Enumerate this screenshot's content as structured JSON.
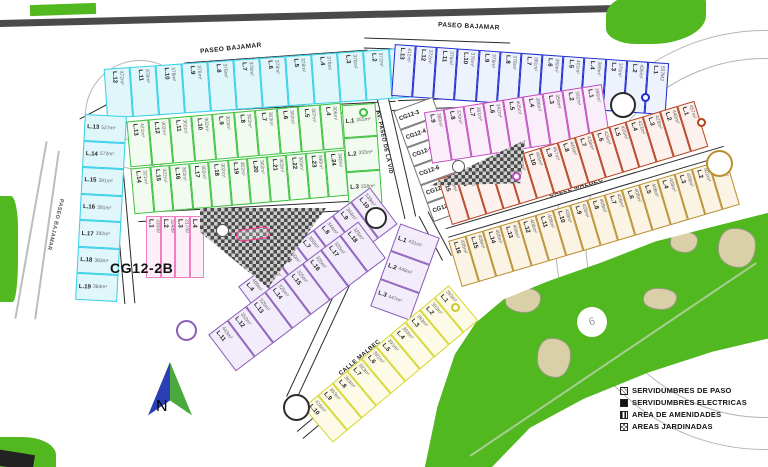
{
  "site_code": "CG12-2B",
  "north": {
    "label": "N"
  },
  "golf": {
    "hole_label": "6"
  },
  "streets": {
    "paseo_bajamar": "PASEO BAJAMAR",
    "calle_nebbiolo": "CALLE NEBBIOLO",
    "calle_pinot_noir": "CALLE PINOT NOIR",
    "av_paseo_de_la_vid": "AV. PASEO DE LA VID",
    "calle_syrah": "CALLE SYRAH",
    "calle_malbec": "CALLE MALBEC"
  },
  "legend": {
    "items": [
      {
        "label": "SERVIDUMBRES DE PASO",
        "swatch": "hatch-diagonal"
      },
      {
        "label": "SERVIDUMBRES ELECTRICAS",
        "swatch": "solid-black"
      },
      {
        "label": "AREA DE AMENIDADES",
        "swatch": "hatch-vertical"
      },
      {
        "label": "AREAS JARDINADAS",
        "swatch": "checker"
      }
    ]
  },
  "colors": {
    "cyan": "#35cfe8",
    "cyan_bg": "#dff6fb",
    "blue": "#1d2bd0",
    "blue_bg": "#eef2fd",
    "green": "#3cc13c",
    "green_bg": "#f2fbef",
    "magenta": "#c14ec1",
    "magenta_bg": "#fbeefb",
    "red_brown": "#b5401d",
    "red_brown_bg": "#fdf1ee",
    "tan": "#b98e2e",
    "tan_bg": "#fbf3e4",
    "lavender": "#8a5cb8",
    "lavender_bg": "#f3ecfa",
    "pink": "#ef7fc0",
    "pink_bg": "#fdeef7",
    "yellow": "#d6d62e",
    "yellow_bg": "#fdfbe8",
    "white_lot": "#777777",
    "white_lot_bg": "#ffffff",
    "golf_green": "#52b820",
    "road_dark": "#4a4a4a"
  },
  "blocks": {
    "cyan_arc": {
      "lots": [
        {
          "n": "L.12",
          "a": "372m²"
        },
        {
          "n": "L.11",
          "a": "378m²"
        },
        {
          "n": "L.10",
          "a": "378m²"
        },
        {
          "n": "L.9",
          "a": "376m²"
        },
        {
          "n": "L.8",
          "a": "376m²"
        },
        {
          "n": "L.7",
          "a": "378m²"
        },
        {
          "n": "L.6",
          "a": "378m²"
        },
        {
          "n": "L.5",
          "a": "378m²"
        },
        {
          "n": "L.4",
          "a": "378m²"
        },
        {
          "n": "L.3",
          "a": "378m²"
        },
        {
          "n": "L.2",
          "a": "372m²"
        },
        {
          "n": "L.1",
          "a": "412m²"
        }
      ]
    },
    "cyan_col": {
      "lots": [
        {
          "n": "L.13",
          "a": "527m²"
        },
        {
          "n": "L.14",
          "a": "572m²"
        },
        {
          "n": "L.15",
          "a": "391m²"
        },
        {
          "n": "L.16",
          "a": "391m²"
        },
        {
          "n": "L.17",
          "a": "392m²"
        },
        {
          "n": "L.18",
          "a": "383m²"
        },
        {
          "n": "L.19",
          "a": "384m²"
        }
      ]
    },
    "blue_arc": {
      "lots": [
        {
          "n": "L.13",
          "a": "412m²"
        },
        {
          "n": "L.12",
          "a": "372m²"
        },
        {
          "n": "L.11",
          "a": "376m²"
        },
        {
          "n": "L.10",
          "a": "376m²"
        },
        {
          "n": "L.9",
          "a": "378m²"
        },
        {
          "n": "L.8",
          "a": "378m²"
        },
        {
          "n": "L.7",
          "a": "381m²"
        },
        {
          "n": "L.6",
          "a": "390m²"
        },
        {
          "n": "L.5",
          "a": "401m²"
        },
        {
          "n": "L.4",
          "a": "389m²"
        },
        {
          "n": "L.3",
          "a": "370m²"
        },
        {
          "n": "L.2",
          "a": "435m²"
        },
        {
          "n": "L.1",
          "a": "557M2"
        }
      ]
    },
    "green_row1": {
      "lots": [
        {
          "n": "L.13",
          "a": "421m²"
        },
        {
          "n": "L.12",
          "a": "302m²"
        },
        {
          "n": "L.11",
          "a": "302m²"
        },
        {
          "n": "L.10",
          "a": "302m²"
        },
        {
          "n": "L.9",
          "a": "303m²"
        },
        {
          "n": "L.8",
          "a": "302m²"
        },
        {
          "n": "L.7",
          "a": "303m²"
        },
        {
          "n": "L.6",
          "a": "302m²"
        },
        {
          "n": "L.5",
          "a": "307m²"
        },
        {
          "n": "L.4",
          "a": "306m²"
        }
      ]
    },
    "green_row2": {
      "lots": [
        {
          "n": "L.14",
          "a": "321m²"
        },
        {
          "n": "L.15",
          "a": "322m²"
        },
        {
          "n": "L.16",
          "a": "302m²"
        },
        {
          "n": "L.17",
          "a": "302m²"
        },
        {
          "n": "L.18",
          "a": "302m²"
        },
        {
          "n": "L.19",
          "a": "302m²"
        },
        {
          "n": "L.20",
          "a": "302m²"
        },
        {
          "n": "L.21",
          "a": "303m²"
        },
        {
          "n": "L.22",
          "a": "303m²"
        },
        {
          "n": "L.23",
          "a": "340m²"
        },
        {
          "n": "L.24",
          "a": "340m²"
        }
      ]
    },
    "green_col": {
      "lots": [
        {
          "n": "L.1",
          "a": "355m²"
        },
        {
          "n": "L.2",
          "a": "355m²"
        },
        {
          "n": "L.3",
          "a": "356m²"
        }
      ]
    },
    "cg_col": {
      "lots": [
        {
          "n": "CG12-3"
        },
        {
          "n": "CG12-4"
        },
        {
          "n": "CG12-5"
        },
        {
          "n": "CG12-6"
        },
        {
          "n": "CG12-7"
        },
        {
          "n": "CG12-8"
        }
      ]
    },
    "magenta_row": {
      "lots": [
        {
          "n": "L.9",
          "a": "380m²"
        },
        {
          "n": "L.8",
          "a": "370m²"
        },
        {
          "n": "L.7",
          "a": "361m²"
        },
        {
          "n": "L.6",
          "a": "342m²"
        },
        {
          "n": "L.5",
          "a": "405m²"
        },
        {
          "n": "L.4",
          "a": "386m²"
        },
        {
          "n": "L.3",
          "a": "350m²"
        },
        {
          "n": "L.2",
          "a": "392m²"
        },
        {
          "n": "L.1",
          "a": "390m²"
        }
      ]
    },
    "malbec_upper": {
      "lots": [
        {
          "n": "L.15",
          "a": "440m²"
        },
        {
          "n": "L.14",
          "a": "467m²"
        },
        {
          "n": "L.13",
          "a": "465m²"
        },
        {
          "n": "L.12",
          "a": "450m²"
        },
        {
          "n": "L.11",
          "a": "470m²"
        },
        {
          "n": "L.10",
          "a": "465m²"
        },
        {
          "n": "L.9",
          "a": "457m²"
        },
        {
          "n": "L.8",
          "a": "445m²"
        },
        {
          "n": "L.7",
          "a": "438m²"
        },
        {
          "n": "L.6",
          "a": "426m²"
        },
        {
          "n": "L.5",
          "a": "420m²"
        },
        {
          "n": "L.4",
          "a": "423m²"
        },
        {
          "n": "L.3",
          "a": "428m²"
        },
        {
          "n": "L.2",
          "a": "440m²"
        },
        {
          "n": "L.1",
          "a": "457m²"
        }
      ]
    },
    "malbec_lower": {
      "lots": [
        {
          "n": "L.16",
          "a": "435m²"
        },
        {
          "n": "L.15",
          "a": "408m²"
        },
        {
          "n": "L.14",
          "a": "406m²"
        },
        {
          "n": "L.13",
          "a": "406m²"
        },
        {
          "n": "L.12",
          "a": "408m²"
        },
        {
          "n": "L.11",
          "a": "408m²"
        },
        {
          "n": "L.10",
          "a": "408m²"
        },
        {
          "n": "L.9",
          "a": "408m²"
        },
        {
          "n": "L.8",
          "a": "408m²"
        },
        {
          "n": "L.7",
          "a": "408m²"
        },
        {
          "n": "L.6",
          "a": "408m²"
        },
        {
          "n": "L.5",
          "a": "408m²"
        },
        {
          "n": "L.4",
          "a": "408m²"
        },
        {
          "n": "L.3",
          "a": "408m²"
        },
        {
          "n": "L.2",
          "a": "502m²"
        },
        {
          "n": "L.1",
          "a": "506m²"
        }
      ]
    },
    "pink_row": {
      "lots": [
        {
          "n": "L.1",
          "a": "330m²"
        },
        {
          "n": "L.2",
          "a": "324m²"
        },
        {
          "n": "L.3",
          "a": "317m²"
        },
        {
          "n": "L.4",
          "a": "318m²"
        }
      ]
    },
    "syrah_ne": {
      "lots": [
        {
          "n": "L.1",
          "a": "431m²"
        },
        {
          "n": "L.2",
          "a": "448m²"
        },
        {
          "n": "L.3",
          "a": "447m²"
        }
      ]
    },
    "syrah_row1": {
      "lots": [
        {
          "n": "L.4",
          "a": "400m²"
        },
        {
          "n": "L.5",
          "a": "350m²"
        },
        {
          "n": "L.6",
          "a": "350m²"
        },
        {
          "n": "L.7",
          "a": "350m²"
        },
        {
          "n": "L.8",
          "a": "344m²"
        },
        {
          "n": "L.9",
          "a": "344m²"
        },
        {
          "n": "L.10",
          "a": "539m²"
        }
      ]
    },
    "syrah_row2": {
      "lots": [
        {
          "n": "L.11",
          "a": "443m²"
        },
        {
          "n": "L.12",
          "a": "352m²"
        },
        {
          "n": "L.13",
          "a": "325m²"
        },
        {
          "n": "L.14",
          "a": "325m²"
        },
        {
          "n": "L.15",
          "a": "325m²"
        },
        {
          "n": "L.16",
          "a": "325m²"
        },
        {
          "n": "L.17",
          "a": "325m²"
        },
        {
          "n": "L.18",
          "a": "325m²"
        }
      ]
    },
    "yellow_row": {
      "lots": [
        {
          "n": "L.10",
          "a": "416m²"
        },
        {
          "n": "L.9",
          "a": "393m²"
        },
        {
          "n": "L.8",
          "a": "393m²"
        },
        {
          "n": "L.7",
          "a": "393m²"
        },
        {
          "n": "L.6",
          "a": "391m²"
        },
        {
          "n": "L.5",
          "a": "391m²"
        },
        {
          "n": "L.4",
          "a": "393m²"
        },
        {
          "n": "L.3",
          "a": "393m²"
        },
        {
          "n": "L.2",
          "a": "393m²"
        },
        {
          "n": "L.1",
          "a": "393m²"
        }
      ]
    }
  }
}
